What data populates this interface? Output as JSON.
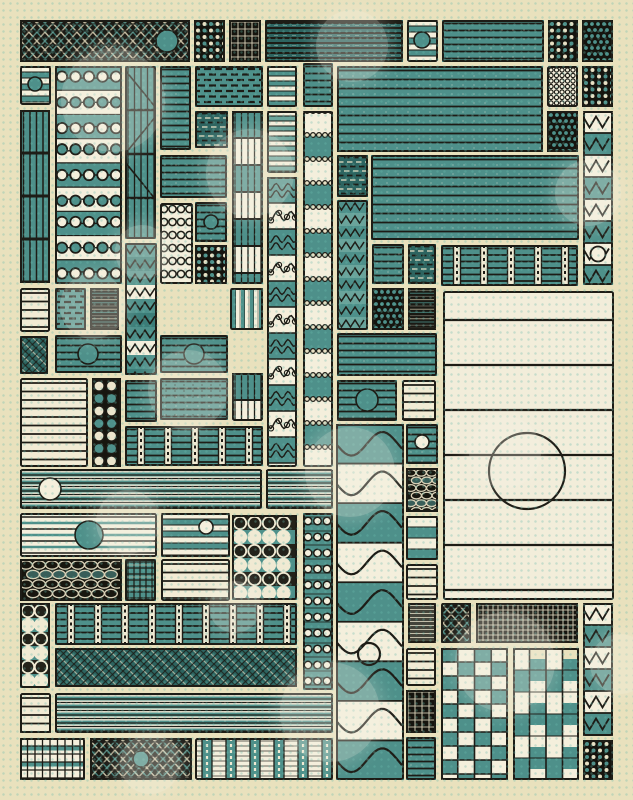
{
  "artwork": {
    "canvas": {
      "width": 633,
      "height": 800
    },
    "palette": {
      "background": "#e9e1bd",
      "cream": "#f1ebd4",
      "cream_bright": "#f4efdc",
      "teal": "#4e908a",
      "teal_light": "#6aa49b",
      "teal_dark": "#3b7d78",
      "teal_deep": "#2d6460",
      "ink": "#1d1c16",
      "black": "#15140e",
      "grey": "#44443a",
      "dot_grid": "#69b9ac",
      "bokeh": "rgba(244,241,228,0.30)"
    },
    "tiles": [
      {
        "x": 20,
        "y": 20,
        "w": 170,
        "h": 42,
        "p": "weave",
        "c": [
          147,
          21,
          11,
          "teal"
        ]
      },
      {
        "x": 194,
        "y": 20,
        "w": 31,
        "h": 42,
        "p": "dots"
      },
      {
        "x": 229,
        "y": 20,
        "w": 32,
        "h": 42,
        "p": "gridD"
      },
      {
        "x": 265,
        "y": 20,
        "w": 138,
        "h": 42,
        "p": "hld"
      },
      {
        "x": 407,
        "y": 20,
        "w": 31,
        "h": 42,
        "p": "stripes",
        "o": {
          "bh": 6
        },
        "c": [
          15,
          20,
          8,
          "teal"
        ]
      },
      {
        "x": 442,
        "y": 20,
        "w": 102,
        "h": 42,
        "p": "hl"
      },
      {
        "x": 548,
        "y": 20,
        "w": 30,
        "h": 42,
        "p": "dots"
      },
      {
        "x": 582,
        "y": 20,
        "w": 31,
        "h": 42,
        "p": "dotsT"
      },
      {
        "x": 20,
        "y": 66,
        "w": 31,
        "h": 39,
        "p": "stripes",
        "o": {
          "bh": 6
        },
        "c": [
          15,
          18,
          7,
          "teal"
        ]
      },
      {
        "x": 55,
        "y": 66,
        "w": 67,
        "h": 218,
        "p": "loops"
      },
      {
        "x": 125,
        "y": 66,
        "w": 31,
        "h": 173,
        "p": "vcurve"
      },
      {
        "x": 160,
        "y": 66,
        "w": 31,
        "h": 84,
        "p": "hl"
      },
      {
        "x": 195,
        "y": 66,
        "w": 68,
        "h": 41,
        "p": "dw"
      },
      {
        "x": 195,
        "y": 111,
        "w": 33,
        "h": 37,
        "p": "dwd"
      },
      {
        "x": 232,
        "y": 111,
        "w": 31,
        "h": 173,
        "p": "vseg"
      },
      {
        "x": 267,
        "y": 66,
        "w": 30,
        "h": 41,
        "p": "stripes",
        "o": {
          "bh": 5
        }
      },
      {
        "x": 267,
        "y": 111,
        "w": 30,
        "h": 62,
        "p": "stripes",
        "o": {
          "bh": 5,
          "light": 1
        }
      },
      {
        "x": 303,
        "y": 63,
        "w": 30,
        "h": 44,
        "p": "hl"
      },
      {
        "x": 337,
        "y": 66,
        "w": 206,
        "h": 86,
        "p": "hl",
        "o": {
          "g": 9
        }
      },
      {
        "x": 547,
        "y": 66,
        "w": 31,
        "h": 41,
        "p": "dotsC"
      },
      {
        "x": 582,
        "y": 66,
        "w": 31,
        "h": 41,
        "p": "dots"
      },
      {
        "x": 547,
        "y": 111,
        "w": 31,
        "h": 41,
        "p": "dotsT"
      },
      {
        "x": 583,
        "y": 111,
        "w": 30,
        "h": 174,
        "p": "zz",
        "o": {
          "q": 6
        }
      },
      {
        "x": 303,
        "y": 111,
        "w": 30,
        "h": 356,
        "p": "chaincol"
      },
      {
        "x": 267,
        "y": 177,
        "w": 30,
        "h": 290,
        "p": "scallop"
      },
      {
        "x": 160,
        "y": 155,
        "w": 67,
        "h": 43,
        "p": "hl"
      },
      {
        "x": 195,
        "y": 202,
        "w": 32,
        "h": 40,
        "p": "hl",
        "c": [
          16,
          20,
          7,
          "teal"
        ]
      },
      {
        "x": 160,
        "y": 203,
        "w": 33,
        "h": 81,
        "p": "chainC"
      },
      {
        "x": 195,
        "y": 245,
        "w": 32,
        "h": 39,
        "p": "dots"
      },
      {
        "x": 337,
        "y": 155,
        "w": 31,
        "h": 42,
        "p": "dwd"
      },
      {
        "x": 337,
        "y": 200,
        "w": 31,
        "h": 130,
        "p": "zzr"
      },
      {
        "x": 371,
        "y": 155,
        "w": 208,
        "h": 85,
        "p": "hl",
        "o": {
          "g": 9
        }
      },
      {
        "x": 372,
        "y": 244,
        "w": 32,
        "h": 40,
        "p": "hl"
      },
      {
        "x": 408,
        "y": 244,
        "w": 28,
        "h": 40,
        "p": "dwd"
      },
      {
        "x": 441,
        "y": 245,
        "w": 137,
        "h": 41,
        "p": "beadgrid"
      },
      {
        "x": 372,
        "y": 288,
        "w": 32,
        "h": 42,
        "p": "dotsT"
      },
      {
        "x": 408,
        "y": 288,
        "w": 28,
        "h": 42,
        "p": "static"
      },
      {
        "x": 443,
        "y": 291,
        "w": 171,
        "h": 309,
        "p": "panel",
        "c": [
          84,
          180,
          38,
          "ring"
        ]
      },
      {
        "x": 20,
        "y": 110,
        "w": 30,
        "h": 173,
        "p": "vgrid"
      },
      {
        "x": 20,
        "y": 288,
        "w": 30,
        "h": 44,
        "p": "hlc"
      },
      {
        "x": 55,
        "y": 288,
        "w": 31,
        "h": 42,
        "p": "dw"
      },
      {
        "x": 90,
        "y": 288,
        "w": 29,
        "h": 42,
        "p": "static"
      },
      {
        "x": 125,
        "y": 243,
        "w": 32,
        "h": 132,
        "p": "wavyT"
      },
      {
        "x": 20,
        "y": 336,
        "w": 28,
        "h": 38,
        "p": "weaveG"
      },
      {
        "x": 55,
        "y": 335,
        "w": 67,
        "h": 38,
        "p": "hl",
        "c": [
          33,
          19,
          10,
          "teal"
        ]
      },
      {
        "x": 160,
        "y": 335,
        "w": 68,
        "h": 38,
        "p": "hl",
        "c": [
          34,
          19,
          10,
          "teal"
        ]
      },
      {
        "x": 230,
        "y": 288,
        "w": 33,
        "h": 42,
        "p": "vlc"
      },
      {
        "x": 20,
        "y": 378,
        "w": 68,
        "h": 89,
        "p": "hlc"
      },
      {
        "x": 92,
        "y": 378,
        "w": 29,
        "h": 89,
        "p": "rings"
      },
      {
        "x": 125,
        "y": 380,
        "w": 32,
        "h": 42,
        "p": "hl"
      },
      {
        "x": 160,
        "y": 378,
        "w": 68,
        "h": 42,
        "p": "hl",
        "o": {
          "gridy": 1
        }
      },
      {
        "x": 232,
        "y": 373,
        "w": 31,
        "h": 48,
        "p": "vseg"
      },
      {
        "x": 125,
        "y": 426,
        "w": 138,
        "h": 40,
        "p": "beadgrid"
      },
      {
        "x": 337,
        "y": 333,
        "w": 100,
        "h": 43,
        "p": "hl"
      },
      {
        "x": 337,
        "y": 380,
        "w": 60,
        "h": 41,
        "p": "hl",
        "c": [
          30,
          20,
          11,
          "teal"
        ]
      },
      {
        "x": 402,
        "y": 380,
        "w": 34,
        "h": 41,
        "p": "hlc"
      },
      {
        "x": 336,
        "y": 424,
        "w": 68,
        "h": 356,
        "p": "sine",
        "c": [
          33,
          230,
          11,
          "ring"
        ]
      },
      {
        "x": 406,
        "y": 424,
        "w": 32,
        "h": 40,
        "p": "hl",
        "c": [
          16,
          18,
          7,
          "cream"
        ]
      },
      {
        "x": 406,
        "y": 468,
        "w": 32,
        "h": 44,
        "p": "ringsW",
        "o": {
          "small": 1
        }
      },
      {
        "x": 406,
        "y": 516,
        "w": 32,
        "h": 44,
        "p": "stripes",
        "o": {
          "bh": 11
        }
      },
      {
        "x": 406,
        "y": 564,
        "w": 32,
        "h": 36,
        "p": "hlc"
      },
      {
        "x": 408,
        "y": 603,
        "w": 28,
        "h": 40,
        "p": "statG"
      },
      {
        "x": 406,
        "y": 648,
        "w": 30,
        "h": 38,
        "p": "hlc"
      },
      {
        "x": 406,
        "y": 690,
        "w": 30,
        "h": 43,
        "p": "gridD"
      },
      {
        "x": 406,
        "y": 737,
        "w": 30,
        "h": 43,
        "p": "hl"
      },
      {
        "x": 20,
        "y": 469,
        "w": 242,
        "h": 40,
        "p": "stripesF",
        "c": [
          30,
          20,
          11,
          "cream"
        ]
      },
      {
        "x": 266,
        "y": 469,
        "w": 67,
        "h": 40,
        "p": "stripesF"
      },
      {
        "x": 20,
        "y": 513,
        "w": 137,
        "h": 44,
        "p": "hlc2",
        "c": [
          69,
          22,
          14,
          "teal"
        ]
      },
      {
        "x": 161,
        "y": 513,
        "w": 69,
        "h": 44,
        "p": "stripes",
        "o": {
          "bh": 6
        },
        "c": [
          45,
          14,
          7,
          "cream"
        ]
      },
      {
        "x": 232,
        "y": 515,
        "w": 65,
        "h": 85,
        "p": "bigrings"
      },
      {
        "x": 303,
        "y": 513,
        "w": 30,
        "h": 177,
        "p": "chaincol2"
      },
      {
        "x": 20,
        "y": 559,
        "w": 102,
        "h": 42,
        "p": "ringsW"
      },
      {
        "x": 125,
        "y": 559,
        "w": 31,
        "h": 42,
        "p": "grid"
      },
      {
        "x": 161,
        "y": 559,
        "w": 69,
        "h": 42,
        "p": "hlc"
      },
      {
        "x": 20,
        "y": 603,
        "w": 30,
        "h": 85,
        "p": "bigrings",
        "o": {
          "col": 1
        }
      },
      {
        "x": 55,
        "y": 603,
        "w": 242,
        "h": 42,
        "p": "beadgrid"
      },
      {
        "x": 55,
        "y": 648,
        "w": 242,
        "h": 39,
        "p": "weaveG"
      },
      {
        "x": 20,
        "y": 693,
        "w": 31,
        "h": 40,
        "p": "hlc"
      },
      {
        "x": 55,
        "y": 693,
        "w": 278,
        "h": 40,
        "p": "stripesF"
      },
      {
        "x": 20,
        "y": 738,
        "w": 65,
        "h": 42,
        "p": "gridF"
      },
      {
        "x": 90,
        "y": 738,
        "w": 102,
        "h": 42,
        "p": "weave",
        "c": [
          51,
          21,
          8,
          "teal"
        ]
      },
      {
        "x": 195,
        "y": 738,
        "w": 138,
        "h": 42,
        "p": "vbead"
      },
      {
        "x": 441,
        "y": 603,
        "w": 30,
        "h": 40,
        "p": "weave"
      },
      {
        "x": 476,
        "y": 603,
        "w": 102,
        "h": 40,
        "p": "gridD",
        "o": {
          "fine": 1
        }
      },
      {
        "x": 583,
        "y": 603,
        "w": 30,
        "h": 133,
        "p": "zz"
      },
      {
        "x": 583,
        "y": 740,
        "w": 30,
        "h": 40,
        "p": "dots"
      },
      {
        "x": 441,
        "y": 648,
        "w": 67,
        "h": 132,
        "p": "checker"
      },
      {
        "x": 513,
        "y": 648,
        "w": 66,
        "h": 132,
        "p": "checker2"
      }
    ],
    "bokeh": [
      [
        113,
        100,
        52
      ],
      [
        352,
        46,
        36
      ],
      [
        250,
        173,
        44
      ],
      [
        93,
        306,
        33
      ],
      [
        142,
        252,
        27
      ],
      [
        188,
        390,
        40
      ],
      [
        588,
        193,
        33
      ],
      [
        128,
        522,
        32
      ],
      [
        350,
        472,
        45
      ],
      [
        505,
        452,
        36
      ],
      [
        235,
        607,
        26
      ],
      [
        330,
        712,
        50
      ],
      [
        505,
        662,
        50
      ],
      [
        620,
        664,
        30
      ],
      [
        150,
        764,
        30
      ]
    ]
  }
}
